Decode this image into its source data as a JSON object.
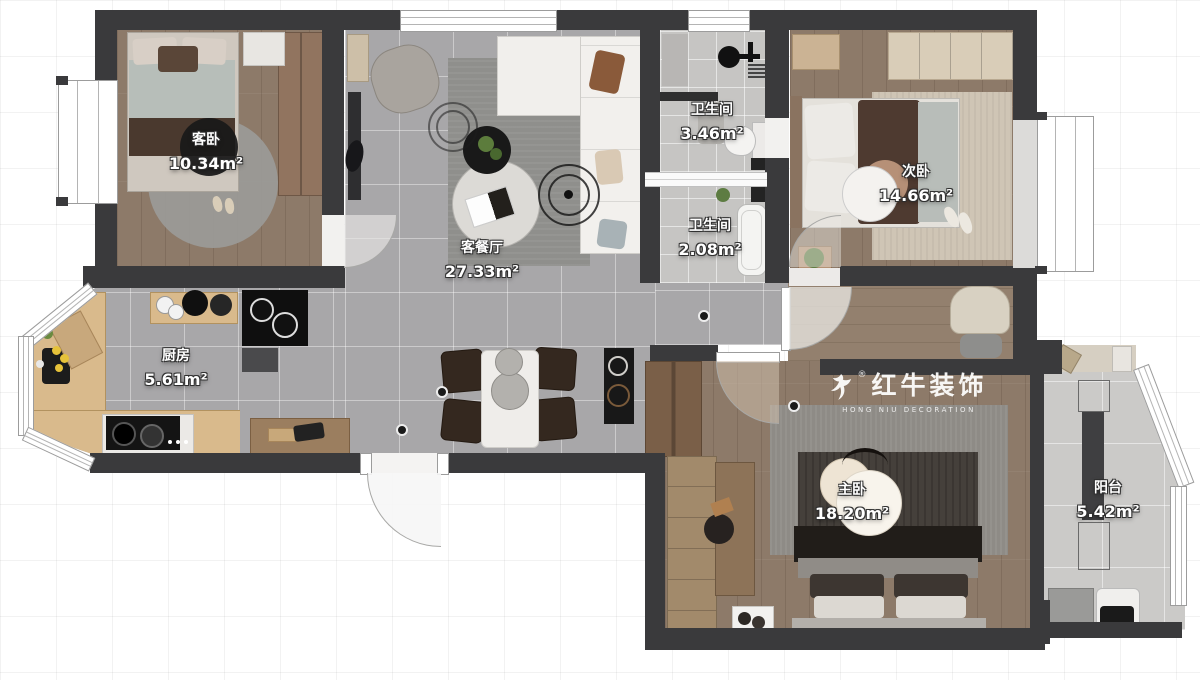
{
  "plan": {
    "brand": {
      "name": "红牛装饰",
      "subtitle": "HONG NIU DECORATION",
      "registered": "®"
    },
    "rooms": [
      {
        "id": "guest-bedroom",
        "name": "客卧",
        "area": "10.34m²"
      },
      {
        "id": "living-dining",
        "name": "客餐厅",
        "area": "27.33m²"
      },
      {
        "id": "bathroom-main",
        "name": "卫生间",
        "area": "3.46m²"
      },
      {
        "id": "bathroom-small",
        "name": "卫生间",
        "area": "2.08m²"
      },
      {
        "id": "second-bedroom",
        "name": "次卧",
        "area": "14.66m²"
      },
      {
        "id": "kitchen",
        "name": "厨房",
        "area": "5.61m²"
      },
      {
        "id": "master-bedroom",
        "name": "主卧",
        "area": "18.20m²"
      },
      {
        "id": "balcony",
        "name": "阳台",
        "area": "5.42m²"
      }
    ],
    "palette": {
      "wall": "#3a3a3c",
      "wood_floor": "#8d7a69",
      "tile_floor": "#a8a7a9",
      "bath_tile": "#c6c5c3",
      "balcony_tile": "#cbcac8",
      "counter_wood": "#d9ba8c",
      "label_text": "#ffffff",
      "watermark": "#ffffff"
    }
  }
}
